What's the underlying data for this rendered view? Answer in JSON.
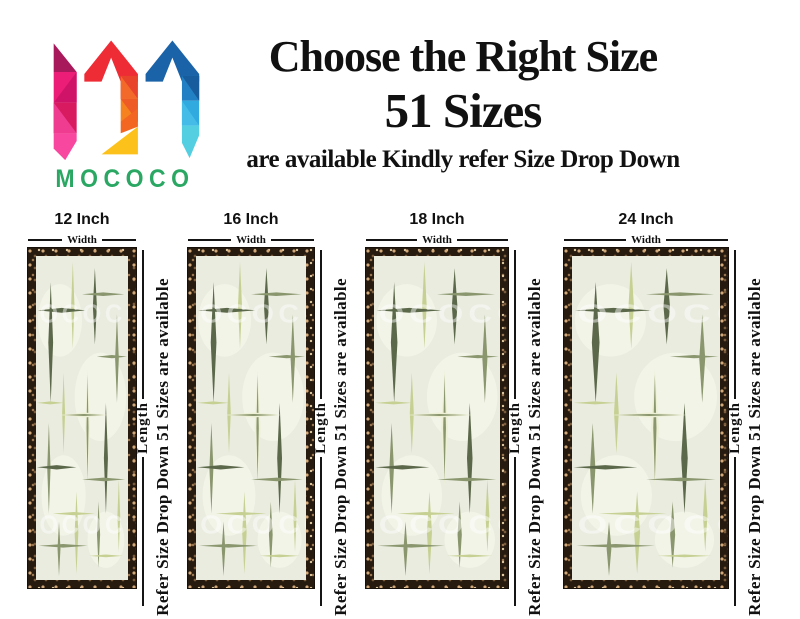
{
  "brand": {
    "name": "MOCOCO"
  },
  "header": {
    "title_line1": "Choose the Right Size",
    "title_line2": "51 Sizes",
    "subtitle": "are available Kindly refer Size Drop Down"
  },
  "dimension_labels": {
    "width": "Width",
    "length": "Length"
  },
  "side_note": "Refer Size Drop Down 51 Sizes are available",
  "panels": [
    {
      "size_label": "12 Inch"
    },
    {
      "size_label": "16 Inch"
    },
    {
      "size_label": "18 Inch"
    },
    {
      "size_label": "24 Inch"
    }
  ],
  "watermark": "MOCOCO",
  "colors": {
    "brand_green": "#2aa863",
    "text": "#111111",
    "glass_background": "#e9ecdf",
    "streak_dark_olive": "#5c684a",
    "streak_mid_olive": "#8a966e",
    "streak_lime": "#c6d092",
    "streak_highlight": "#eef0d6",
    "border_brown": "#271b10"
  }
}
